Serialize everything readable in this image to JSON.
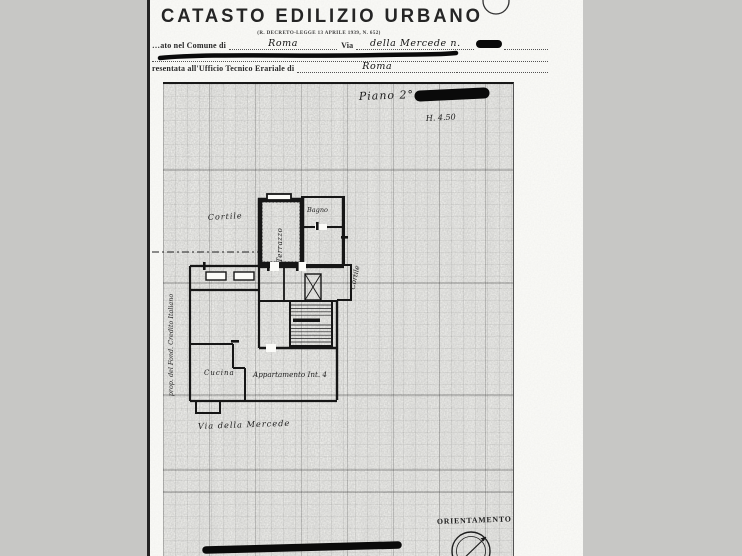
{
  "header": {
    "title": "CATASTO EDILIZIO URBANO",
    "subtitle": "(R. DECRETO-LEGGE 13 APRILE 1939, N. 652)",
    "line1_label": "…ato nel Comune di",
    "line1_value": "Roma",
    "line1_via_label": "Via",
    "line1_via_value": "della Mercede  n.",
    "line3_label": "resentata all'Ufficio Tecnico Erariale di",
    "line3_value": "Roma"
  },
  "plan": {
    "floor": "Piano 2°",
    "height": "H. 4.50",
    "labels": {
      "cortile_left": "Cortile",
      "bagno": "Bagno",
      "terrazzo": "Terrazzo",
      "cortile_right": "Cortile",
      "cucina": "Cucina",
      "apartment": "Appartamento  Int. 4",
      "street": "Via della Mercede",
      "owner": "prop. del Fond. Credito Italiano"
    },
    "orientation": "ORIENTAMENTO"
  },
  "colors": {
    "ink": "#161616",
    "paper": "#fbfbf8",
    "background": "#c7c7c5"
  }
}
